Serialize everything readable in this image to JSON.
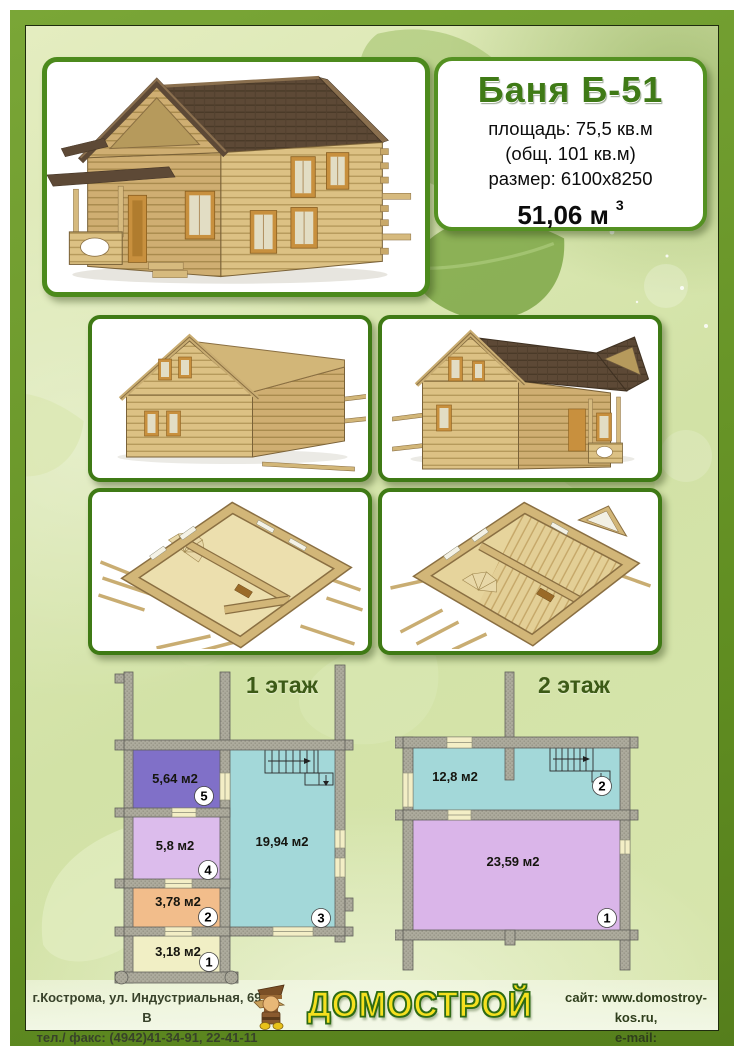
{
  "header": {
    "model": "Баня Б-51",
    "specs": [
      "площадь: 75,5 кв.м",
      "(общ. 101 кв.м)",
      "размер: 6100х8250"
    ],
    "volume": "51,06 м",
    "volume_sup": "3"
  },
  "images": {
    "main": "log-bathhouse-front-perspective-render",
    "rear": "log-bathhouse-rear-view-render",
    "side": "log-bathhouse-side-view-render",
    "interior_floor1": "log-bathhouse-floor1-cutaway-render",
    "interior_floor2": "log-bathhouse-floor2-cutaway-render"
  },
  "floor_plans": {
    "floor1": {
      "title": "1 этаж",
      "rooms": [
        {
          "number": "5",
          "area": "5,64 м2",
          "color": "#8070c8"
        },
        {
          "number": "4",
          "area": "5,8 м2",
          "color": "#dcbcec"
        },
        {
          "number": "2",
          "area": "3,78 м2",
          "color": "#f2bd8b"
        },
        {
          "number": "1",
          "area": "3,18 м2",
          "color": "#f1efc5"
        },
        {
          "number": "3",
          "area": "19,94 м2",
          "color": "#a3d8d9"
        }
      ]
    },
    "floor2": {
      "title": "2 этаж",
      "rooms": [
        {
          "number": "2",
          "area": "12,8 м2",
          "color": "#a3d8d9"
        },
        {
          "number": "1",
          "area": "23,59 м2",
          "color": "#dab5e9"
        }
      ]
    }
  },
  "footer": {
    "address_line1": "г.Кострома, ул. Индустриальная, 69 В",
    "address_line2": "тел./ факс: (4942)41-34-91, 22-41-11",
    "logo_text": "ДОМОСТРОЙ",
    "contact_line1": "сайт: www.domostroy-kos.ru,",
    "contact_line2": "e-mail: domostroy_kos@mail.ru"
  },
  "theme": {
    "frame_green": "#6c9a2b",
    "box_border_green": "#3f7a15",
    "title_green": "#3f7a16",
    "plan_title_green": "#3c5a16",
    "logo_yellow": "#f5e01e",
    "logo_outline_green": "#2e6b14",
    "wall_gray": "#adab9d"
  }
}
